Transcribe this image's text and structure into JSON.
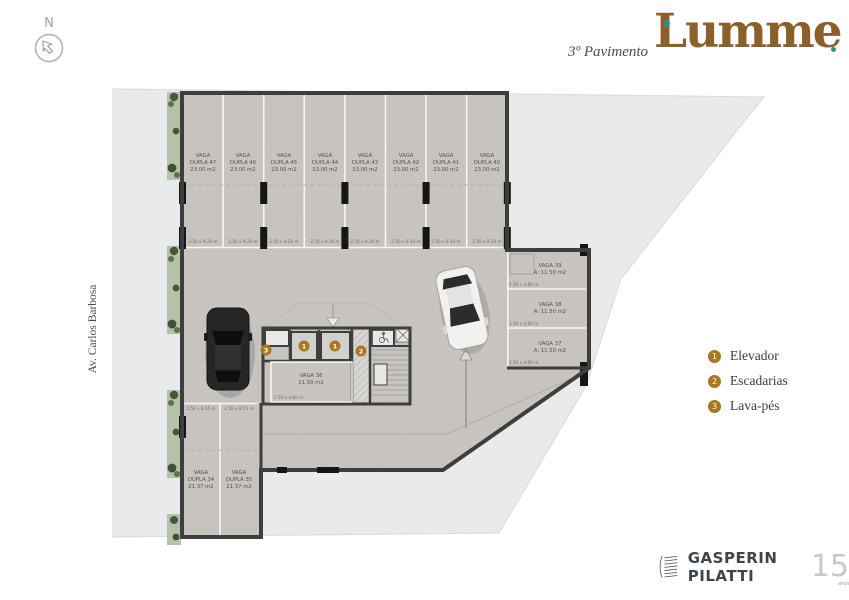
{
  "header": {
    "floor_label": "3º Pavimento",
    "brand": "Lumme"
  },
  "compass": {
    "letter": "N"
  },
  "street": {
    "label": "Av. Carlos Barbosa"
  },
  "legend": {
    "items": [
      {
        "num": "1",
        "label": "Elevador"
      },
      {
        "num": "2",
        "label": "Escadarias"
      },
      {
        "num": "3",
        "label": "Lava-pés"
      }
    ]
  },
  "footer": {
    "brand": "GASPERIN PILATTI",
    "badge_number": "15",
    "badge_suffix": "anos"
  },
  "plan": {
    "top_spots": [
      {
        "line1": "VAGA",
        "line2": "DUPLA 47",
        "line3": "23.00 m2",
        "dim": "2.50 x 9.20 m"
      },
      {
        "line1": "VAGA",
        "line2": "DUPLA 46",
        "line3": "23.00 m2",
        "dim": "2.50 x 9.20 m"
      },
      {
        "line1": "VAGA",
        "line2": "DUPLA 45",
        "line3": "23.00 m2",
        "dim": "2.50 x 9.20 m"
      },
      {
        "line1": "VAGA",
        "line2": "DUPLA 44",
        "line3": "23.00 m2",
        "dim": "2.50 x 9.20 m"
      },
      {
        "line1": "VAGA",
        "line2": "DUPLA 43",
        "line3": "23.00 m2",
        "dim": "2.50 x 9.20 m"
      },
      {
        "line1": "VAGA",
        "line2": "DUPLA 42",
        "line3": "23.00 m2",
        "dim": "2.50 x 9.20 m"
      },
      {
        "line1": "VAGA",
        "line2": "DUPLA 41",
        "line3": "23.00 m2",
        "dim": "2.50 x 9.20 m"
      },
      {
        "line1": "VAGA",
        "line2": "DUPLA 40",
        "line3": "23.00 m2",
        "dim": "2.50 x 9.20 m"
      }
    ],
    "side_spots": [
      {
        "line1": "VAGA 39",
        "line2": "A: 11.50 m2",
        "dim": "2.50 x 4.60 m"
      },
      {
        "line1": "VAGA 38",
        "line2": "A: 11.50 m2",
        "dim": "2.50 x 4.60 m"
      },
      {
        "line1": "VAGA 37",
        "line2": "A: 11.50 m2",
        "dim": "2.50 x 4.60 m"
      }
    ],
    "center_spot": {
      "line1": "VAGA 36",
      "line2": "11.50 m2",
      "dim": "2.50 x 4.60 m"
    },
    "bottom_spots": [
      {
        "line1": "VAGA",
        "line2": "DUPLA 34",
        "line3": "21.37 m2",
        "dim": "2.50 x 8.55 m"
      },
      {
        "line1": "VAGA",
        "line2": "DUPLA 35",
        "line3": "21.37 m2",
        "dim": "2.50 x 8.55 m"
      }
    ],
    "markers": {
      "elevator_a": "1",
      "elevator_b": "1",
      "stairs": "2",
      "footwash": "3"
    }
  },
  "colors": {
    "accent_gold": "#a8771e",
    "brand_brown": "#8d5f2a",
    "brand_teal": "#2e8f8f",
    "wall": "#3e3e3e",
    "site_gray": "#e9eaeb",
    "concrete": "#c9c6c2"
  }
}
